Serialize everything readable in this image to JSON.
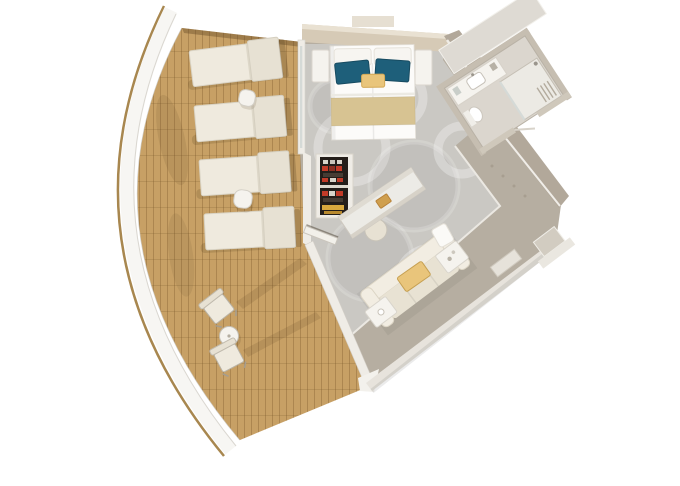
{
  "scene": {
    "type": "3d-floor-plan-render",
    "description": "Top-down 3D rendering of a cruise ship suite with a curved wrap-around teak balcony, bedroom, living area, bathroom and entry hall",
    "background": "#ffffff"
  },
  "colors": {
    "hull_line": "#a8874f",
    "railing_band": "#f7f6f3",
    "railing_edge": "#cfccc5",
    "deck_wood": "#c7a065",
    "deck_plank_line": "rgba(120,85,40,0.35)",
    "hard_floor": "#b6aea1",
    "carpet": "#cac8c3",
    "carpet_trim": "#ebe8e2",
    "wall_white": "#efece6",
    "wall_taupe": "#b2a89a",
    "headboard_wall": "#d6cab6",
    "bed_white": "#fcfbf9",
    "pillow_teal": "#1e5f7a",
    "pillow_gold": "#e9c57b",
    "runner_khaki": "#d7c392",
    "furniture_cream": "#efeade",
    "furniture_cream_dark": "#e7e1d3",
    "minibar_dark": "#241e1a",
    "minibar_red": "#c23b28",
    "minibar_yellow": "#d8a83e",
    "sofa_cream": "#f2ede2",
    "sofa_seat": "#e8e2d3",
    "table_white": "#f5f3ee",
    "bath_floor": "#dbd6ce",
    "bath_wall": "#c6beb1",
    "bath_slab": "#dedad3",
    "fixture_white": "#ffffff",
    "glass": "#d5dad7"
  },
  "rooms": {
    "balcony": {
      "label": "balcony-deck",
      "loungers": 4,
      "lounger_side_tables": 2,
      "bistro_chairs": 2,
      "bistro_tables": 1
    },
    "bedroom": {
      "label": "bedroom",
      "beds": 1,
      "white_pillows": 2,
      "teal_pillows": 2,
      "accent_pillows": 1,
      "nightstands": 2,
      "minibar_shelves": 1,
      "desks": 1,
      "desk_stools": 1
    },
    "living": {
      "label": "living-area",
      "sofas": 1,
      "sofa_accent_pillows": 1,
      "side_tables": 2
    },
    "bathroom": {
      "label": "bathroom",
      "vanities": 1,
      "sinks": 1,
      "showers": 1,
      "toilets": 1
    },
    "entry": {
      "label": "entry-hall"
    }
  }
}
